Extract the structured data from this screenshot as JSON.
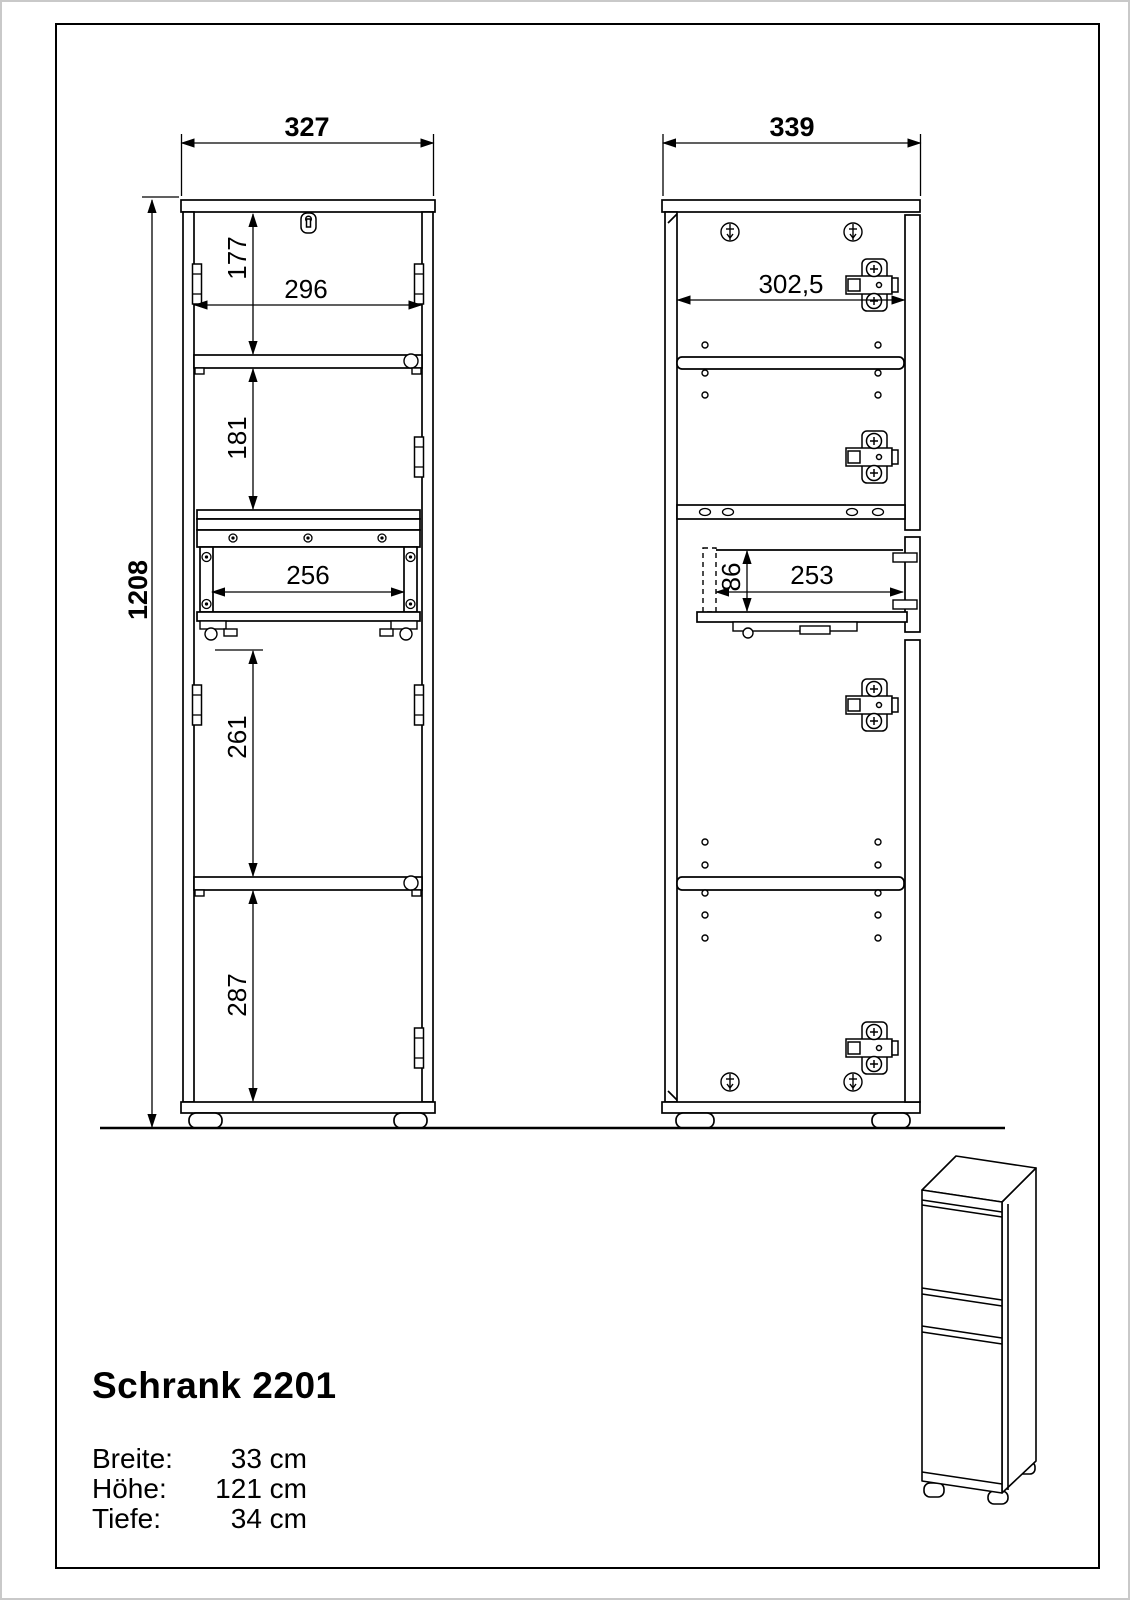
{
  "drawing": {
    "front_view": {
      "width_top": "327",
      "inner_width": "296",
      "total_height": "1208",
      "section_top": "177",
      "section_mid": "181",
      "drawer_inner_width": "256",
      "section_lower": "261",
      "section_bottom": "287"
    },
    "side_view": {
      "width_top": "339",
      "inner_width": "302,5",
      "drawer_height": "86",
      "drawer_depth": "253"
    }
  },
  "info_block": {
    "title": "Schrank 2201",
    "specs": [
      {
        "label": "Breite:",
        "value": "33 cm"
      },
      {
        "label": "Höhe:",
        "value": "121 cm"
      },
      {
        "label": "Tiefe:",
        "value": "34 cm"
      }
    ]
  }
}
